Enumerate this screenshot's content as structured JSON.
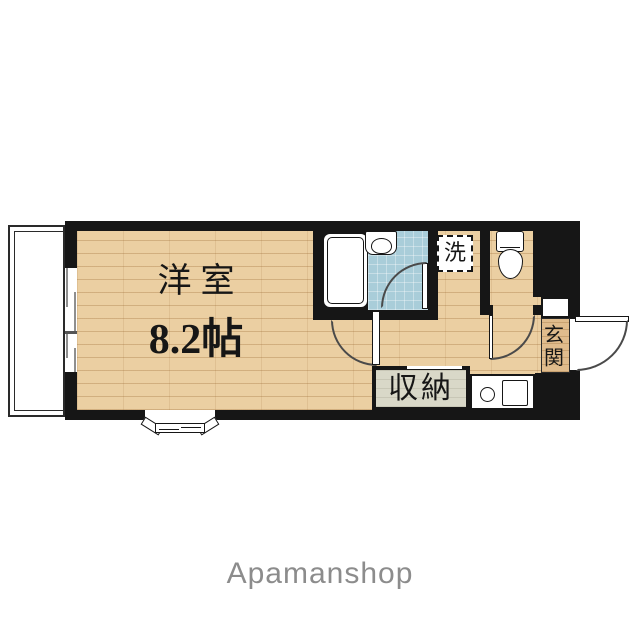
{
  "floorplan": {
    "labels": {
      "main_room_name": "洋室",
      "main_room_size": "8.2帖",
      "storage": "収納",
      "laundry": "洗",
      "entrance": "玄関"
    },
    "colors": {
      "wall": "#161616",
      "wood_floor": "#ebcfa2",
      "bathroom_floor": "#a9cdd9",
      "storage_floor": "#d9d8c8",
      "entrance_floor": "#e0bc8d",
      "fixture": "#ffffff",
      "brand_gray": "#8c8c8c"
    }
  },
  "footer": {
    "brand": "Apamanshop"
  }
}
